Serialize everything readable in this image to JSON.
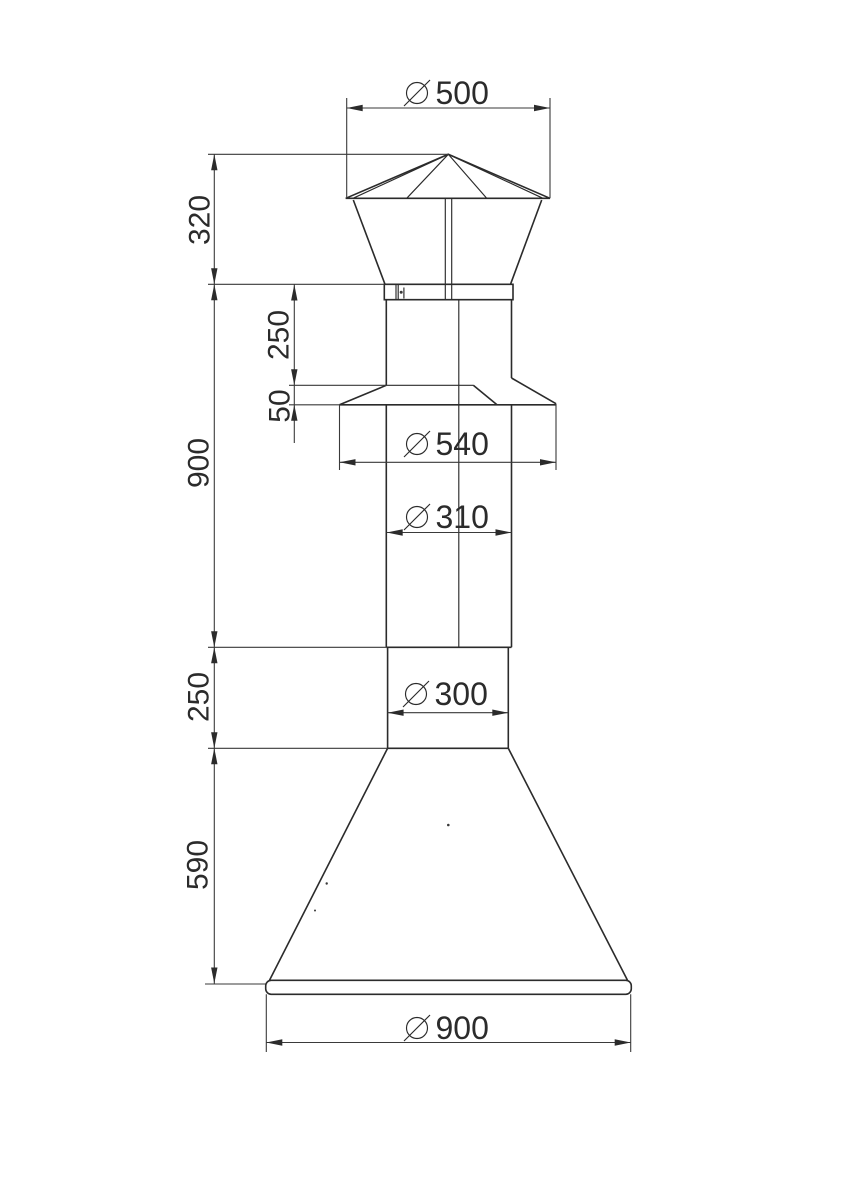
{
  "drawing": {
    "background_color": "#ffffff",
    "line_color": "#2b2b2b",
    "dimensions": {
      "left_chain": [
        {
          "name": "cap-height",
          "label": "320"
        },
        {
          "name": "body-height",
          "label": "900"
        },
        {
          "name": "outlet-height",
          "label": "250"
        },
        {
          "name": "cone-height",
          "label": "590"
        }
      ],
      "upper_chain": [
        {
          "name": "neck-height",
          "label": "250"
        },
        {
          "name": "flange-drop",
          "label": "50"
        }
      ],
      "diameters": [
        {
          "name": "cap-diameter",
          "label": "500"
        },
        {
          "name": "flange-diameter",
          "label": "540"
        },
        {
          "name": "pipe-diameter",
          "label": "310"
        },
        {
          "name": "outlet-diameter",
          "label": "300"
        },
        {
          "name": "base-diameter",
          "label": "900"
        }
      ]
    }
  }
}
